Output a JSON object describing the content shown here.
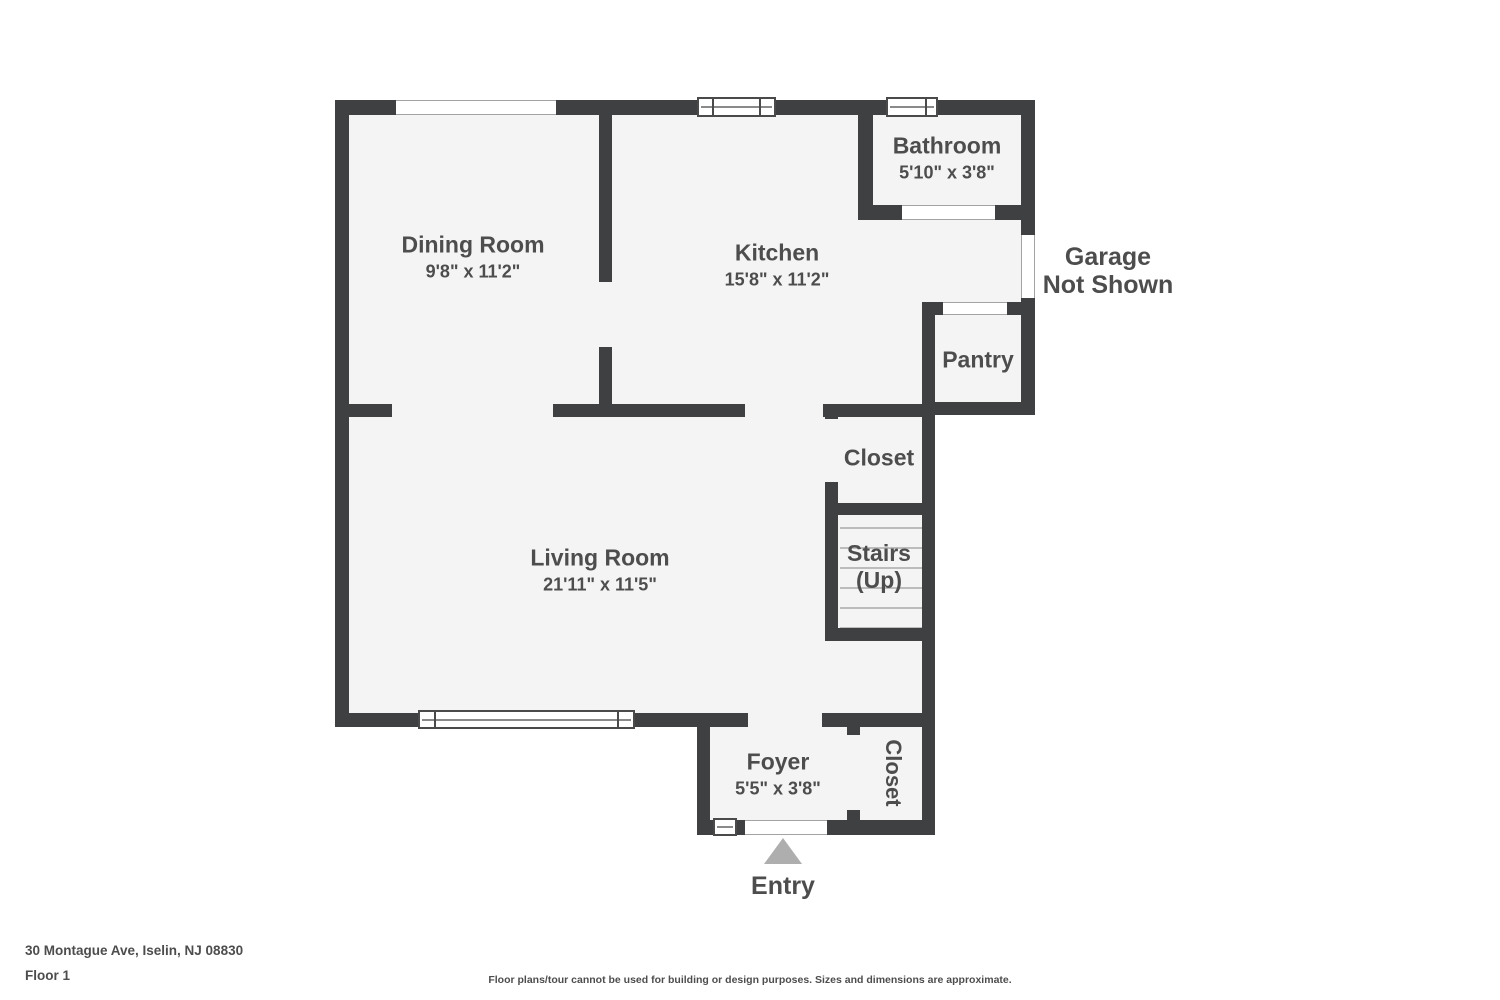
{
  "palette": {
    "wall": "#3e4041",
    "floor": "#f4f4f5",
    "text": "#4d4d4d",
    "stair_tread": "#bcbcbc",
    "entry_arrow": "#aeaeae"
  },
  "rooms": {
    "dining": {
      "name": "Dining Room",
      "dims": "9'8\" x 11'2\""
    },
    "kitchen": {
      "name": "Kitchen",
      "dims": "15'8\" x 11'2\""
    },
    "bathroom": {
      "name": "Bathroom",
      "dims": "5'10\" x 3'8\""
    },
    "pantry": {
      "name": "Pantry"
    },
    "hall_closet": {
      "name": "Closet"
    },
    "stairs": {
      "line1": "Stairs",
      "line2": "(Up)"
    },
    "living": {
      "name": "Living Room",
      "dims": "21'11\" x 11'5\""
    },
    "foyer": {
      "name": "Foyer",
      "dims": "5'5\" x 3'8\""
    },
    "entry_closet": {
      "name": "Closet"
    }
  },
  "garage": {
    "line1": "Garage",
    "line2": "Not Shown"
  },
  "entry": {
    "label": "Entry"
  },
  "footer": {
    "address": "30 Montague Ave, Iselin, NJ 08830",
    "floor": "Floor 1",
    "disclaimer": "Floor plans/tour cannot be used for building or design purposes. Sizes and dimensions are approximate."
  }
}
